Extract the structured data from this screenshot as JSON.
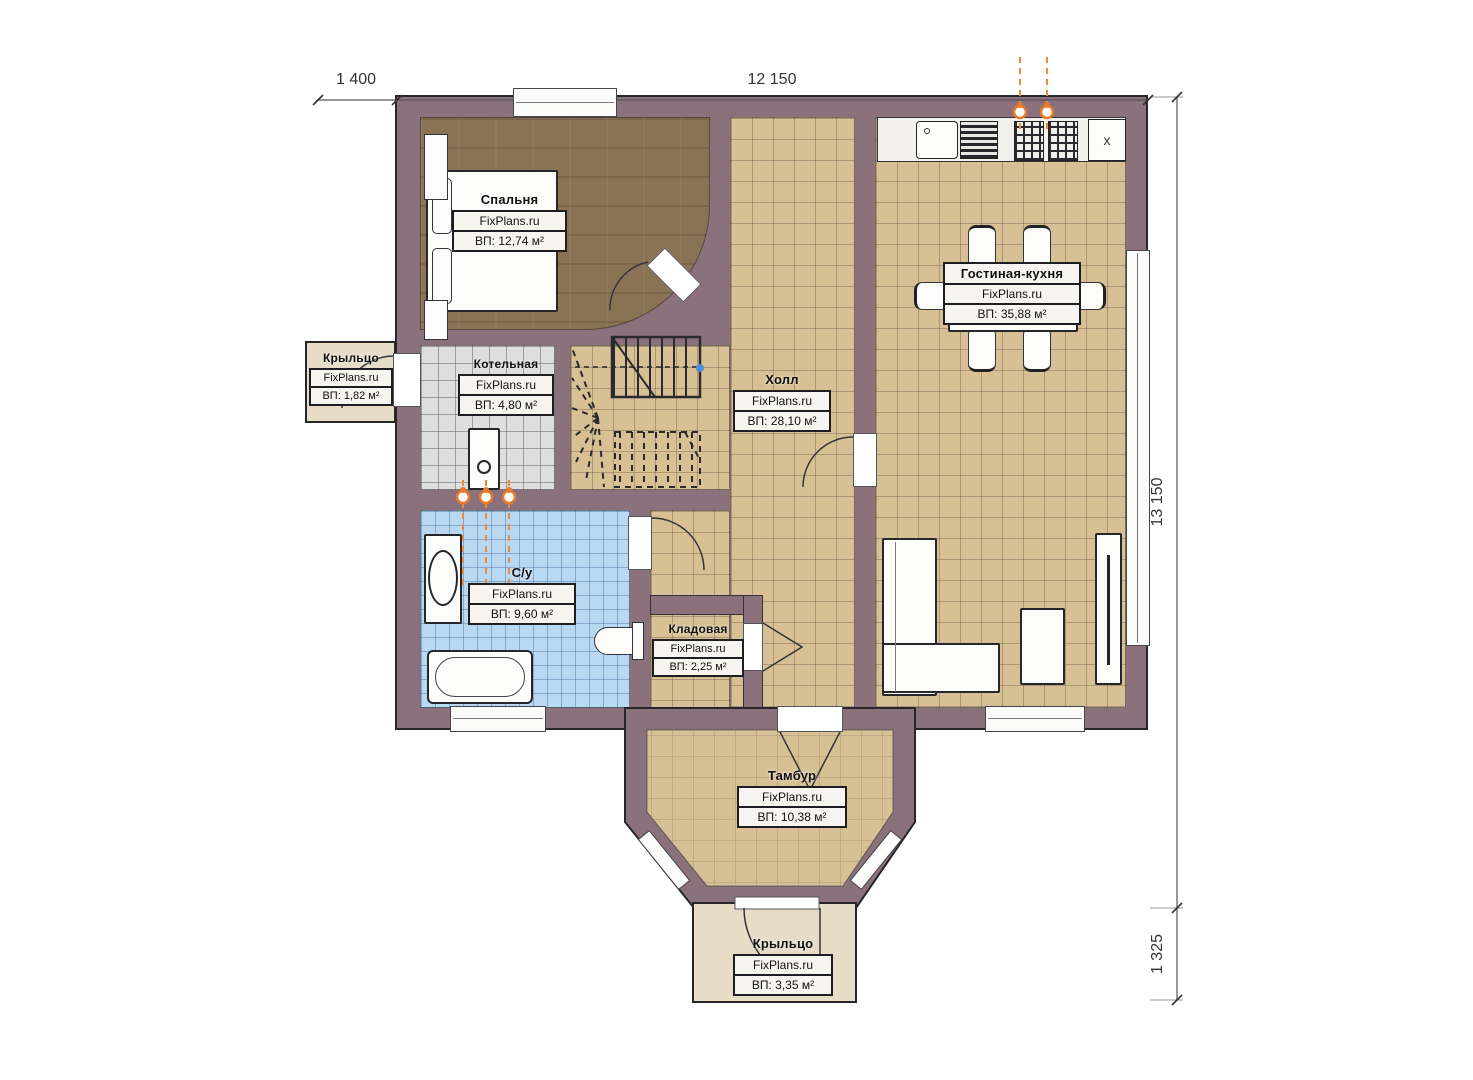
{
  "dimensions": {
    "top_porch": "1 400",
    "top_main": "12 150",
    "right_main": "13 150",
    "right_porch": "1 325"
  },
  "rooms": [
    {
      "name": "Спальня",
      "brand": "FixPlans.ru",
      "area": "ВП: 12,74 м²"
    },
    {
      "name": "Котельная",
      "brand": "FixPlans.ru",
      "area": "ВП: 4,80 м²"
    },
    {
      "name": "Холл",
      "brand": "FixPlans.ru",
      "area": "ВП: 28,10 м²"
    },
    {
      "name": "Гостиная-кухня",
      "brand": "FixPlans.ru",
      "area": "ВП: 35,88 м²"
    },
    {
      "name": "С/у",
      "brand": "FixPlans.ru",
      "area": "ВП: 9,60 м²"
    },
    {
      "name": "Кладовая",
      "brand": "FixPlans.ru",
      "area": "ВП: 2,25 м²"
    },
    {
      "name": "Тамбур",
      "brand": "FixPlans.ru",
      "area": "ВП: 10,38 м²"
    },
    {
      "name": "Крыльцо",
      "brand": "FixPlans.ru",
      "area": "ВП: 1,82 м²"
    },
    {
      "name": "Крыльцо",
      "brand": "FixPlans.ru",
      "area": "ВП: 3,35 м²"
    }
  ],
  "kitchen": {
    "cabinet_label": "x"
  },
  "colors": {
    "wall": "#8b717b",
    "tile_tan": "#d7c093",
    "tile_blue": "#b9d8f1",
    "tile_gray": "#dedede",
    "floor_wood": "#8a7254",
    "porch": "#e7ddc7",
    "accent_orange": "#e87a28"
  }
}
